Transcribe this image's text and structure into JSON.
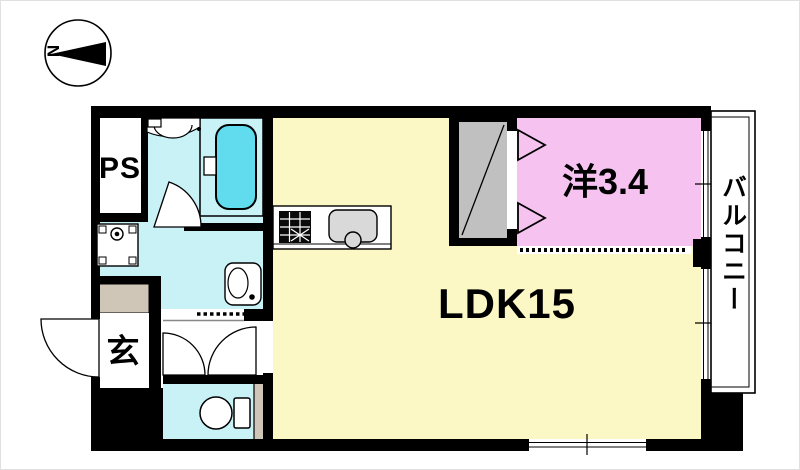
{
  "compass": {
    "north_label": "N"
  },
  "rooms": {
    "ps": {
      "label": "PS"
    },
    "genkan": {
      "label": "玄"
    },
    "ldk": {
      "label": "LDK15"
    },
    "western": {
      "label": "洋3.4"
    },
    "balcony": {
      "label": "バルコニー"
    }
  },
  "colors": {
    "wall": "#000000",
    "ldk": "#fbf8c5",
    "western": "#f6c3f1",
    "wet": "#c9f2f7",
    "tub": "#61dbee",
    "closet": "#c0c0c0",
    "step": "#cfc6b7",
    "fixture": "#d9d9d9"
  }
}
